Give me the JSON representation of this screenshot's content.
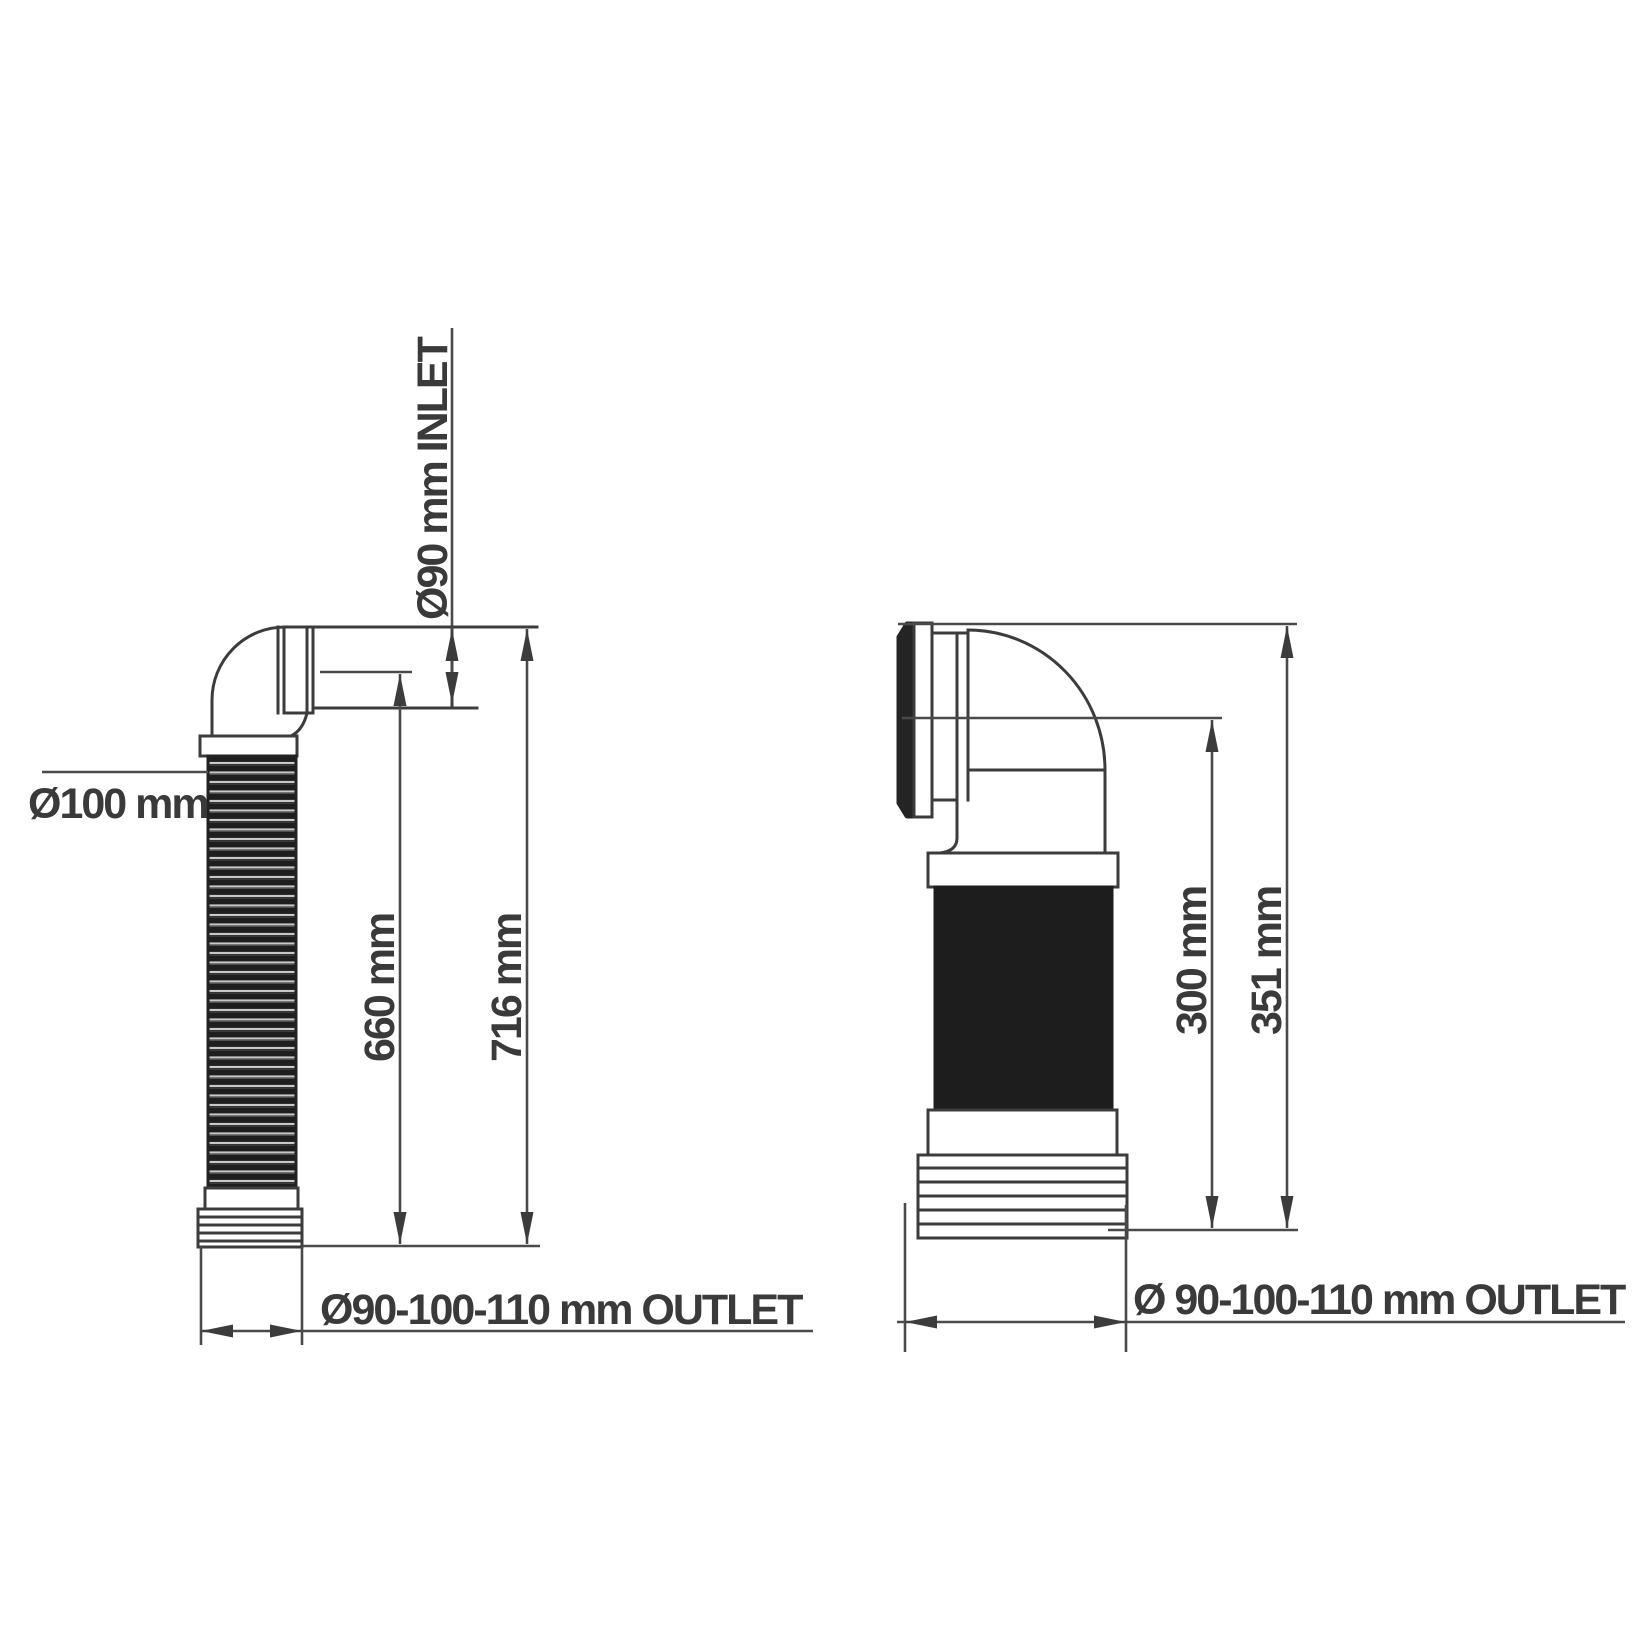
{
  "drawing": {
    "colors": {
      "background": "#ffffff",
      "line": "#3c3c3c",
      "text": "#3a3a3a",
      "sleeve": "#1d1d1d",
      "hose_dark": "#1e1e1e",
      "hose_light": "#c8c8c8"
    },
    "left_figure": {
      "inlet_label": "Ø90 mm INLET",
      "hose_diameter_label": "Ø100 mm",
      "dim_inner": "660 mm",
      "dim_outer": "716 mm",
      "outlet_label": "Ø90-100-110 mm OUTLET"
    },
    "right_figure": {
      "dim_inner": "300 mm",
      "dim_outer": "351 mm",
      "outlet_label": "Ø 90-100-110 mm OUTLET"
    }
  }
}
